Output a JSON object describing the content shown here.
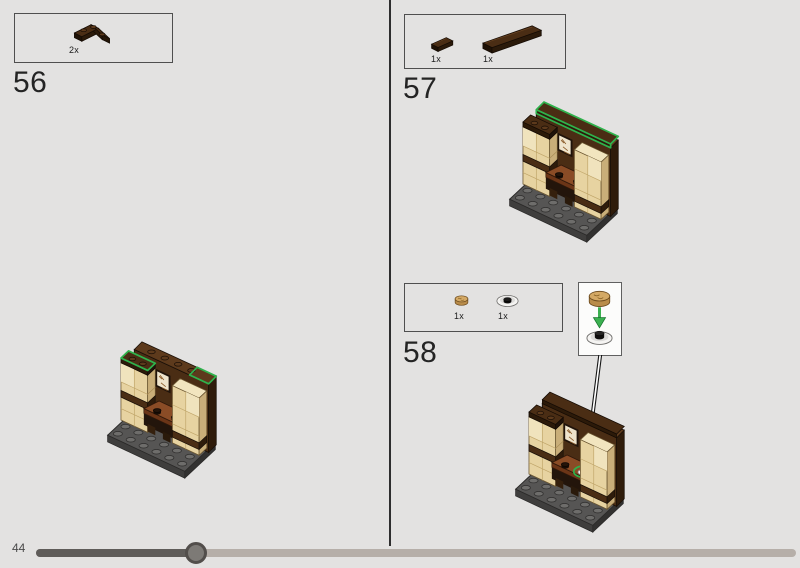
{
  "steps": {
    "s56": {
      "number": "56",
      "parts": [
        {
          "count": "2x",
          "piece": "dark-brown-corner-plate-2x2"
        }
      ]
    },
    "s57": {
      "number": "57",
      "parts": [
        {
          "count": "1x",
          "piece": "dark-brown-tile-1x2"
        },
        {
          "count": "1x",
          "piece": "dark-brown-tile-1x6"
        }
      ]
    },
    "s58": {
      "number": "58",
      "parts": [
        {
          "count": "1x",
          "piece": "tan-round-tile-bread"
        },
        {
          "count": "1x",
          "piece": "white-dish-with-black-stud"
        }
      ]
    }
  },
  "progress": {
    "page_label": "44"
  },
  "colors": {
    "page_background": "#e3e2e1",
    "highlight_green": "#2fb24c",
    "dark_brown": "#4a2d14",
    "reddish_brown_table": "#8a4c26",
    "tan_brick": "#e7d3a1",
    "baseplate_gray": "#504f4e",
    "progress_track": "#b6afa9",
    "progress_fill": "#5f5c59"
  }
}
